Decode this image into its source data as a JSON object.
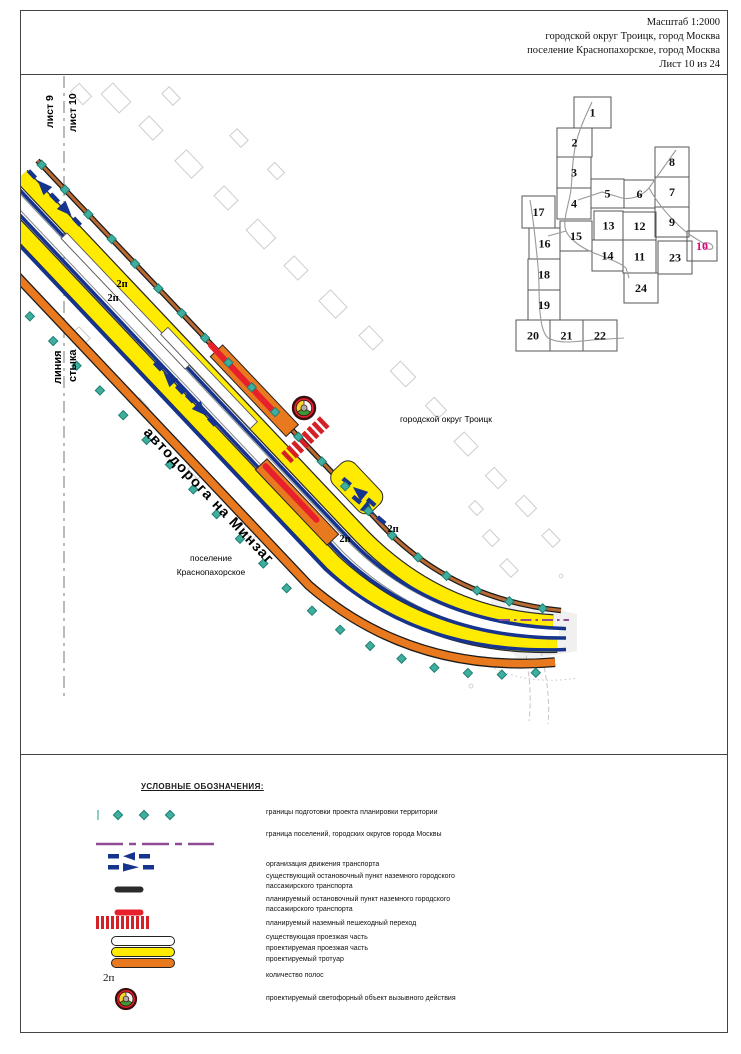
{
  "header": {
    "scale": "Масштаб 1:2000",
    "district": "городской округ Троицк, город Москва",
    "settlement": "поселение Краснопахорское, город Москва",
    "sheet": "Лист 10 из 24"
  },
  "map": {
    "sheet_label_left": "лист 9",
    "sheet_label_right": "лист 10",
    "seam_label_line1": "линия",
    "seam_label_line2": "стыка",
    "road_label": "автодорога на Минзаг",
    "district_label": "городской округ Троицк",
    "settlement_label_line1": "поселение",
    "settlement_label_line2": "Краснопахорское",
    "lane_labels": [
      "2п",
      "2п",
      "2п",
      "2п"
    ]
  },
  "index_map": {
    "current_sheet": "10",
    "tiles": [
      {
        "n": "1",
        "x": 60,
        "y": 9,
        "w": 37,
        "h": 31
      },
      {
        "n": "2",
        "x": 43,
        "y": 40,
        "w": 35,
        "h": 29
      },
      {
        "n": "3",
        "x": 43,
        "y": 69,
        "w": 34,
        "h": 31
      },
      {
        "n": "4",
        "x": 43,
        "y": 100,
        "w": 34,
        "h": 31
      },
      {
        "n": "5",
        "x": 77,
        "y": 91,
        "w": 33,
        "h": 29
      },
      {
        "n": "6",
        "x": 110,
        "y": 92,
        "w": 31,
        "h": 28
      },
      {
        "n": "7",
        "x": 141,
        "y": 89,
        "w": 34,
        "h": 30
      },
      {
        "n": "8",
        "x": 141,
        "y": 59,
        "w": 34,
        "h": 30
      },
      {
        "n": "9",
        "x": 141,
        "y": 119,
        "w": 34,
        "h": 30
      },
      {
        "n": "10",
        "x": 173,
        "y": 143,
        "w": 30,
        "h": 30
      },
      {
        "n": "11",
        "x": 109,
        "y": 152,
        "w": 33,
        "h": 33
      },
      {
        "n": "12",
        "x": 109,
        "y": 124,
        "w": 33,
        "h": 28
      },
      {
        "n": "13",
        "x": 80,
        "y": 123,
        "w": 29,
        "h": 29
      },
      {
        "n": "14",
        "x": 78,
        "y": 152,
        "w": 31,
        "h": 31
      },
      {
        "n": "15",
        "x": 46,
        "y": 133,
        "w": 32,
        "h": 30
      },
      {
        "n": "16",
        "x": 15,
        "y": 140,
        "w": 31,
        "h": 31
      },
      {
        "n": "17",
        "x": 8,
        "y": 108,
        "w": 33,
        "h": 32
      },
      {
        "n": "18",
        "x": 14,
        "y": 171,
        "w": 32,
        "h": 31
      },
      {
        "n": "19",
        "x": 14,
        "y": 202,
        "w": 32,
        "h": 30
      },
      {
        "n": "20",
        "x": 2,
        "y": 232,
        "w": 34,
        "h": 31
      },
      {
        "n": "21",
        "x": 36,
        "y": 232,
        "w": 33,
        "h": 31
      },
      {
        "n": "22",
        "x": 69,
        "y": 232,
        "w": 34,
        "h": 31
      },
      {
        "n": "23",
        "x": 144,
        "y": 153,
        "w": 34,
        "h": 33
      },
      {
        "n": "24",
        "x": 110,
        "y": 185,
        "w": 34,
        "h": 30
      }
    ]
  },
  "legend": {
    "title": "УСЛОВНЫЕ ОБОЗНАЧЕНИЯ:",
    "items": [
      {
        "marker": "boundary-diamonds",
        "label": "границы подготовки проекта планировки территории"
      },
      {
        "marker": "settlement-boundary",
        "label": "граница поселений, городских округов города Москвы"
      },
      {
        "marker": "traffic-arrows",
        "label": "организация движения транспорта"
      },
      {
        "marker": "existing-stop",
        "label": "существующий остановочный пункт наземного городского пассажирского транспорта"
      },
      {
        "marker": "planned-stop",
        "label": "планируемый остановочный пункт наземного городского пассажирского транспорта"
      },
      {
        "marker": "pedestrian-crossing",
        "label": "планируемый наземный пешеходный переход"
      },
      {
        "marker": "existing-roadway",
        "label": "существующая проезжая часть"
      },
      {
        "marker": "planned-roadway",
        "label": "проектируемая проезжая часть"
      },
      {
        "marker": "planned-sidewalk",
        "label": "проектируемый тротуар"
      },
      {
        "marker": "lane-count",
        "label": "количество полос",
        "symbol": "2п"
      },
      {
        "marker": "traffic-signal",
        "label": "проектируемый светофорный объект вызывного действия"
      }
    ]
  },
  "colors": {
    "project_boundary_teal": "#3FAE9E",
    "settlement_boundary_purple": "#8E4D92",
    "traffic_blue": "#16338E",
    "existing_stop_black": "#2B2B2B",
    "planned_stop_red": "#E8202C",
    "crossing_red": "#D42127",
    "planned_road_yellow": "#FFEB00",
    "planned_sidewalk_orange": "#E8791E",
    "sheet_highlight_magenta": "#E6007E"
  }
}
